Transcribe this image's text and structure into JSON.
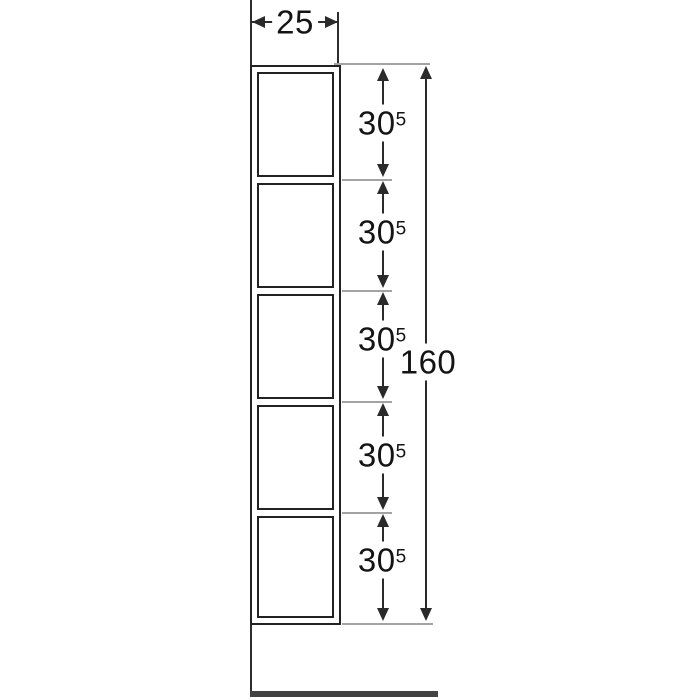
{
  "drawing": {
    "type": "technical-dimension-drawing",
    "subject": "tall wall shelf unit with 5 open compartments, side elevation",
    "width_dim": {
      "value": "25"
    },
    "total_height_dim": {
      "value": "160"
    },
    "compartment_dims": [
      {
        "value": "30",
        "sup": "5"
      },
      {
        "value": "30",
        "sup": "5"
      },
      {
        "value": "30",
        "sup": "5"
      },
      {
        "value": "30",
        "sup": "5"
      },
      {
        "value": "30",
        "sup": "5"
      }
    ],
    "numeric_values_cm": {
      "width": 25,
      "total_height": 160,
      "compartment_heights": [
        30.5,
        30.5,
        30.5,
        30.5,
        30.5
      ]
    },
    "colors": {
      "background": "#ffffff",
      "line": "#2d2d2d",
      "frame": "#222222",
      "dim": "#2a2a2a",
      "extension": "#a3a3a3",
      "floor": "#424242",
      "text": "#141414"
    }
  }
}
